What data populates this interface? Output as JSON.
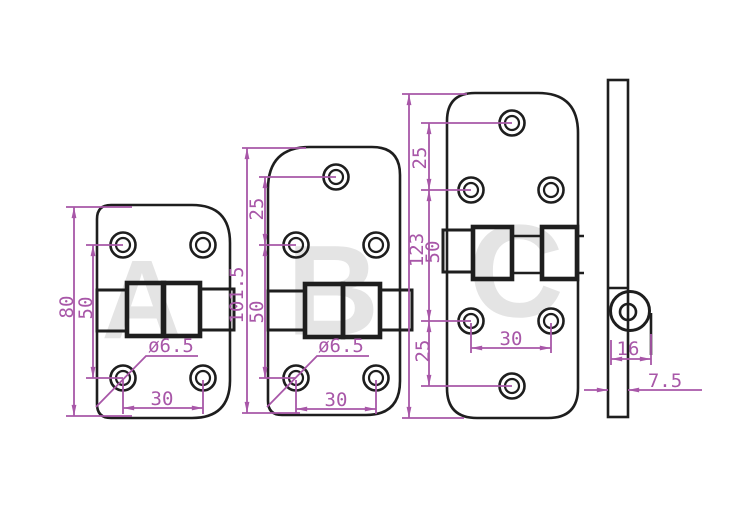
{
  "colors": {
    "line": "#1e1e1e",
    "dim": "#a857a8",
    "watermark": "#e4e4e4",
    "background": "#ffffff"
  },
  "watermarks": {
    "a": "A",
    "b": "B",
    "c": "C"
  },
  "hinge_a": {
    "height": "80",
    "hole_spacing_vertical": "50",
    "hole_diameter": "ø6.5",
    "hole_spacing_horizontal": "30"
  },
  "hinge_b": {
    "height": "101.5",
    "top_hole_offset": "25",
    "hole_spacing_vertical": "50",
    "hole_diameter": "ø6.5",
    "hole_spacing_horizontal": "30"
  },
  "hinge_c": {
    "height": "123",
    "top_hole_offset": "25",
    "hole_spacing_vertical": "50",
    "bottom_hole_offset": "25",
    "hole_spacing_horizontal": "30"
  },
  "side_view": {
    "knuckle_width": "16",
    "leaf_thickness": "7.5"
  }
}
